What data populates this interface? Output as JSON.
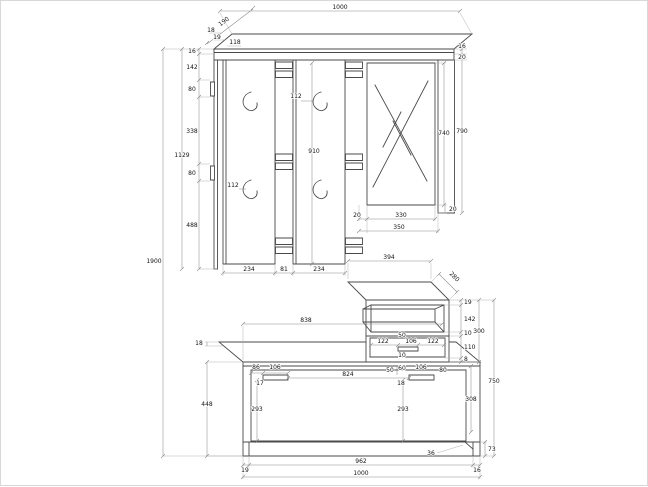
{
  "upper": {
    "total_width": "1000",
    "shelf_depth": "190",
    "shelf_t1": "18",
    "shelf_t2": "19",
    "shelf_offset": "118",
    "right_t1": "16",
    "right_t2": "20",
    "chain_1": "16",
    "chain_2": "142",
    "chain_3": "80",
    "chain_4": "338",
    "chain_5": "80",
    "chain_6": "488",
    "panel_height": "1129",
    "overall_height": "1900",
    "hook_offset_top": "112",
    "hook_offset_bottom": "112",
    "board_length": "910",
    "mirror_height": "740",
    "side_height": "790",
    "mirror_gap_left": "20",
    "mirror_width": "330",
    "mirror_gap_bottom": "20",
    "mirror_total": "350",
    "board_left_width": "234",
    "board_gap": "81",
    "board_right_width": "234"
  },
  "lower": {
    "cabinet_width": "394",
    "cabinet_depth": "280",
    "cab_chain_1": "19",
    "cab_chain_2": "142",
    "cab_chain_3": "10",
    "cab_chain_4": "110",
    "cab_chain_5": "8",
    "cabinet_height": "300",
    "drawer_margin_left": "122",
    "drawer_handle_offset": "50",
    "drawer_handle_width": "106",
    "drawer_margin_right": "122",
    "drawer_gap": "10",
    "bench_top_width": "838",
    "bench_top_thickness": "18",
    "bench_side_height": "448",
    "lh_margin": "86",
    "lh_width": "106",
    "lh_offset": "17",
    "rh_offset_top": "50",
    "rh_margin_left": "60",
    "rh_width": "106",
    "rh_margin_right": "80",
    "rh_height": "18",
    "handle_span": "824",
    "door_height_left": "293",
    "door_height_right": "293",
    "inner_height": "308",
    "total_height": "750",
    "plinth_height": "73",
    "plinth_inset": "36",
    "bottom_left": "19",
    "bottom_width": "962",
    "bottom_right": "16",
    "bottom_total": "1000"
  }
}
